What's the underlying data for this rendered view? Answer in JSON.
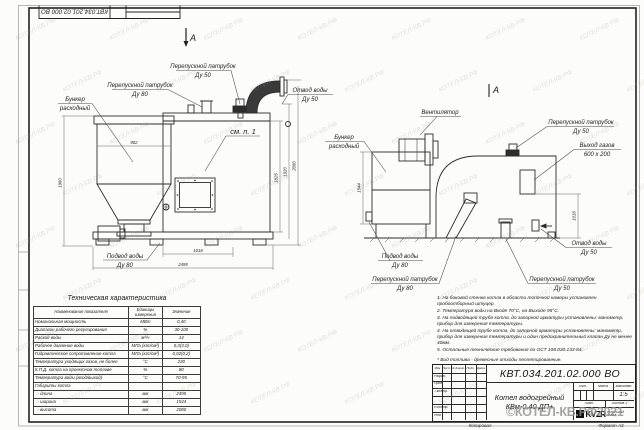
{
  "sheet": {
    "stamp_doc_number": "КВТ.034.201.02.000 ВО",
    "footer_copy": "Копировал",
    "footer_format": "Формат А3"
  },
  "watermark": {
    "tile": "КОТЕЛ-КВ.РФ",
    "stamp": "©КОТЕЛ-КВ.РФ2021"
  },
  "left_view": {
    "section_mark": "А",
    "label_bunker_1": "Бункер",
    "label_bunker_2": "расходный",
    "label_bypass80_1": "Перепускной патрубок",
    "label_bypass80_2": "Ду 80",
    "label_bypass50_1": "Перепускной патрубок",
    "label_bypass50_2": "Ду 50",
    "label_outlet_1": "Отвод воды",
    "label_outlet_2": "Ду 50",
    "label_inlet_1": "Подвод воды",
    "label_inlet_2": "Ду 80",
    "label_see_note": "см. п. 1",
    "dim_hopper_width": "902",
    "dim_total_height_left": "1960",
    "dim_bottom_1": "1018",
    "dim_bottom_2": "2495",
    "dim_right_1": "1825",
    "dim_right_2": "1920",
    "dim_right_3": "2080"
  },
  "right_view": {
    "section_mark": "А",
    "label_fan": "Вентилятор",
    "label_bunker_1": "Бункер",
    "label_bunker_2": "расходный",
    "label_bypass50_top_1": "Перепускной патрубок",
    "label_bypass50_top_2": "Ду 50",
    "label_gas_out_1": "Выход газов",
    "label_gas_out_2": "600 х 200",
    "label_outlet_1": "Отвод воды",
    "label_outlet_2": "Ду 50",
    "label_inlet_1": "Подвод воды",
    "label_inlet_2": "Ду 80",
    "label_bypass80_1": "Перепускной патрубок",
    "label_bypass80_2": "Ду 80",
    "label_bypass50_bot_1": "Перепускной патрубок",
    "label_bypass50_bot_2": "Ду 50",
    "dim_depth": "1544",
    "dim_right": "1018"
  },
  "tech_table": {
    "title": "Техническая характеристика",
    "col_name": "Наименование показателя",
    "col_units": "Единицы измерения",
    "col_value": "Значение",
    "rows": [
      {
        "name": "Номинальная мощность",
        "units": "МВт",
        "value": "0,40"
      },
      {
        "name": "Диапазон рабочего регулирования",
        "units": "%",
        "value": "30-100"
      },
      {
        "name": "Расход воды",
        "units": "м³/ч",
        "value": "14"
      },
      {
        "name": "Рабочее давление воды",
        "units": "МПа (кгс/см²)",
        "value": "0,3(3,0)"
      },
      {
        "name": "Гидравлическое сопротивление котла",
        "units": "МПа (кгс/см²)",
        "value": "0,02(0,2)"
      },
      {
        "name": "Температура уходящих газов, не более",
        "units": "°С",
        "value": "230"
      },
      {
        "name": "К.П.Д. котла на проектном топливе",
        "units": "%",
        "value": "80"
      },
      {
        "name": "Температура воды (вход/выход)",
        "units": "°С",
        "value": "70-95"
      },
      {
        "name": "Габариты котла",
        "units": "",
        "value": ""
      },
      {
        "name": "  - длина",
        "units": "мм",
        "value": "2495"
      },
      {
        "name": "  - ширина",
        "units": "мм",
        "value": "1544"
      },
      {
        "name": "  - высота",
        "units": "мм",
        "value": "2080"
      }
    ]
  },
  "notes": {
    "items": [
      "1. На боковой стенке котла в области топочной камеры установлен пробоотборный штуцер.",
      "2. Температура воды на Входе 70°С, на Выходе 95°С.",
      "3. На подводящей трубе котла, до запорной арматуры установлены: манометр, прибор для измерения температуры.",
      "4. На отводящей трубе котла, до запорной арматуры установлены: манометр, прибор для измерения температуры и один предохранительный клапан Ду не менее 40мм.",
      "5. Остальные технические требования по ОСТ 108.030.133-84."
    ],
    "fuel": "* Вид топлива - древесные отходы пеллетированные."
  },
  "title_block": {
    "doc_number": "КВТ.034.201.02.000  ВО",
    "name_line1": "Котел водогрейный",
    "name_line2": "КВм-0,40  ДП+",
    "col_izm": "Изм",
    "col_list": "Лист",
    "col_doc": "№ докум.",
    "col_sign": "Подп.",
    "col_date": "Дата",
    "sig_rows": [
      "Разраб.",
      "Пров.",
      "Т.контр.",
      "Н.контр.",
      "Утв."
    ],
    "lit_label": "Лит.",
    "mass_label": "Масса",
    "scale_label": "Масштаб",
    "scale_value": "1:5",
    "sheet_label": "Лист",
    "sheets_label": "Листов 1",
    "logo_text": "KVZR",
    "logo_sub": "КОТЕЛЬНЫЙ ЗАВОД"
  }
}
